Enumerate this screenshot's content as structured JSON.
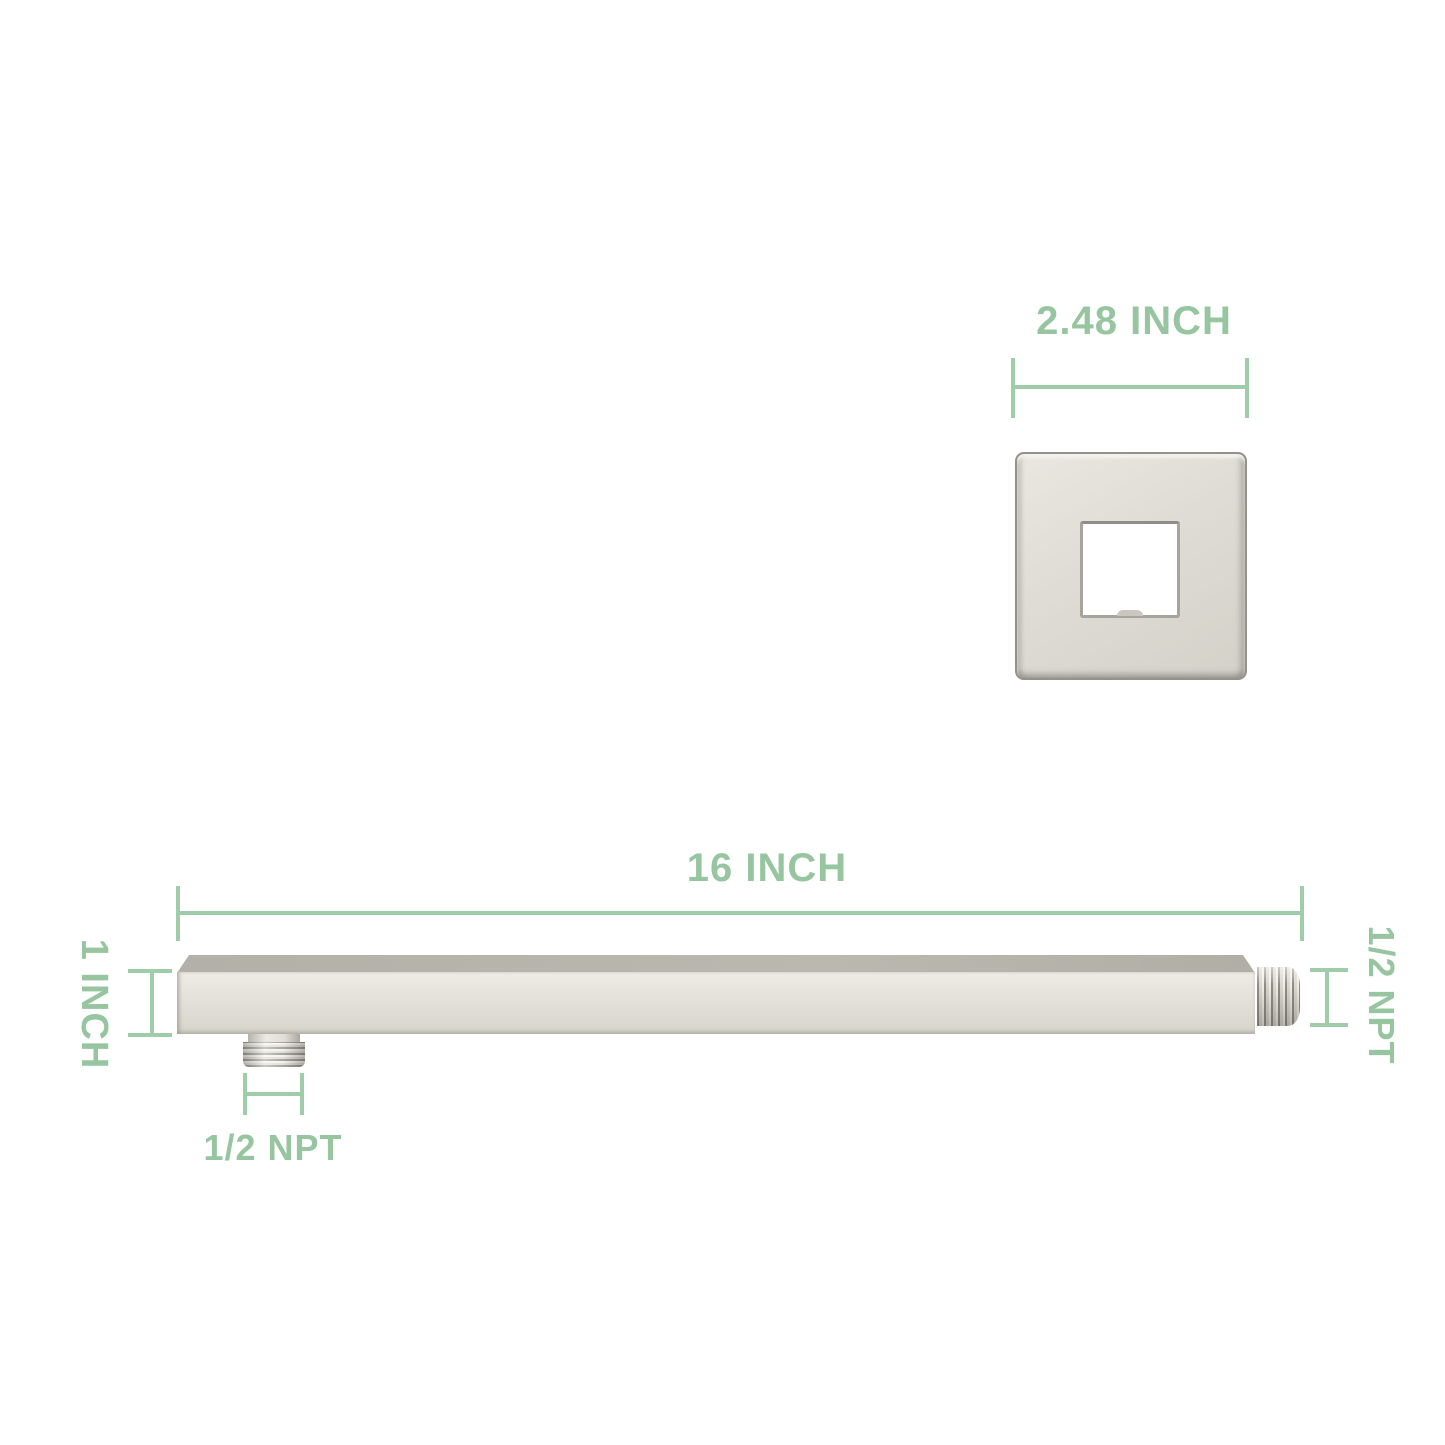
{
  "diagram": {
    "labels": {
      "flange_width": "2.48 INCH",
      "arm_length": "16 INCH",
      "arm_thickness": "1 INCH",
      "bottom_connector_thread": "1/2 NPT",
      "end_connector_thread": "1/2 NPT"
    },
    "colors": {
      "annotation_text": "#96c5a0",
      "annotation_line": "#9fcda9",
      "metal_face": "#e3e1d9",
      "metal_top": "#b6b4ab",
      "metal_edge": "#94928b",
      "background": "#ffffff"
    }
  }
}
